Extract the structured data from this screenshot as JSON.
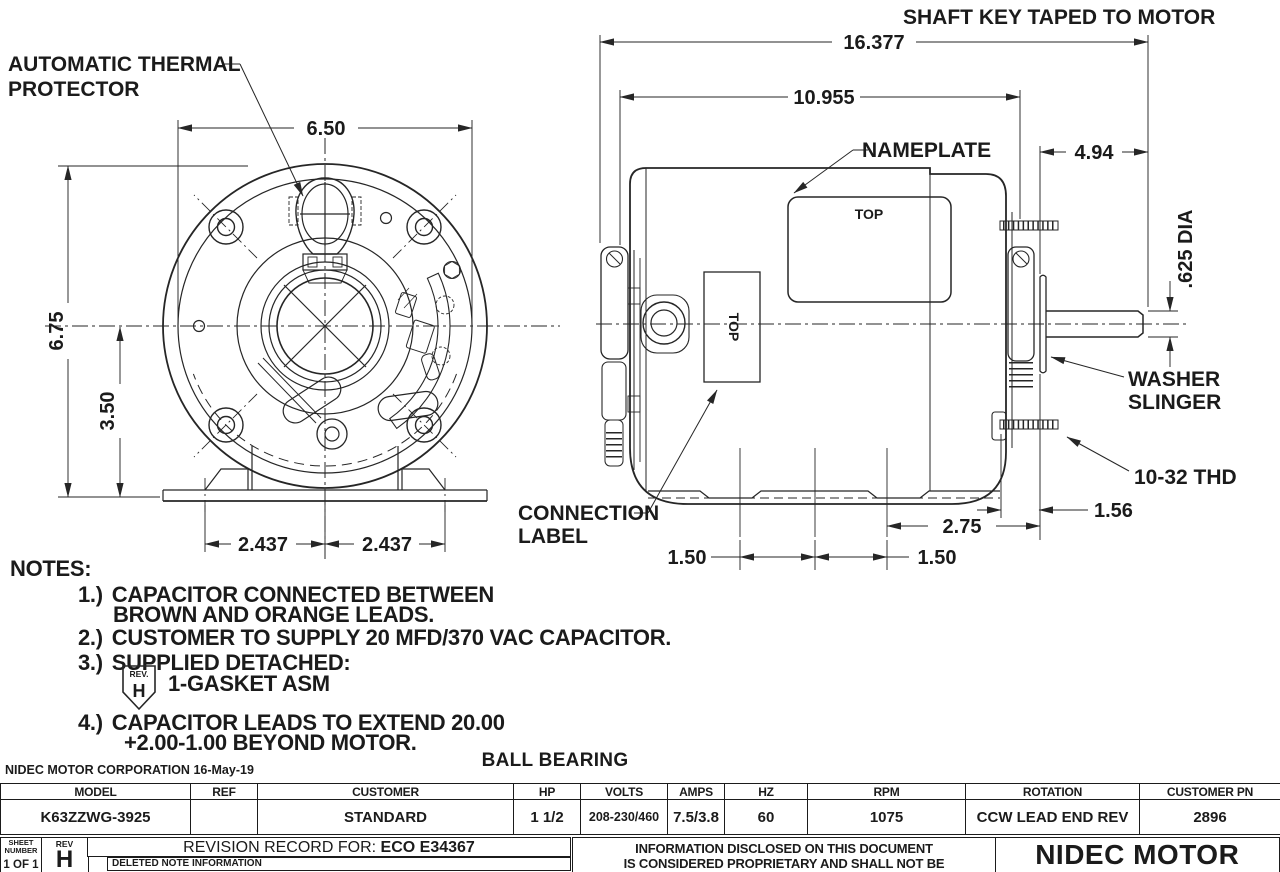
{
  "drawing": {
    "labels": {
      "thermal_line1": "AUTOMATIC THERMAL",
      "thermal_line2": "PROTECTOR",
      "shaft_key": "SHAFT KEY TAPED TO MOTOR",
      "nameplate": "NAMEPLATE",
      "nameplate_top": "TOP",
      "connection_top": "TOP",
      "washer_line1": "WASHER",
      "washer_line2": "SLINGER",
      "thread_spec": "10-32 THD",
      "connection_line1": "CONNECTION",
      "connection_line2": "LABEL"
    },
    "dims": {
      "front_width": "6.50",
      "front_height": "6.75",
      "shaft_centerline_height": "3.50",
      "foot_left": "2.437",
      "foot_right": "2.437",
      "overall_length": "16.377",
      "body_length": "10.955",
      "shaft_extension": "4.94",
      "shaft_dia": ".625 DIA",
      "stud_length": "1.56",
      "foot_to_end": "2.75",
      "bolt_spacing_a": "1.50",
      "bolt_spacing_b": "1.50"
    }
  },
  "notes": {
    "title": "NOTES:",
    "n1_num": "1.)",
    "n1_line1": "CAPACITOR CONNECTED BETWEEN",
    "n1_line2": "BROWN AND ORANGE LEADS.",
    "n2_num": "2.)",
    "n2_line1": "CUSTOMER TO SUPPLY 20 MFD/370 VAC CAPACITOR.",
    "n3_num": "3.)",
    "n3_line1": "SUPPLIED DETACHED:",
    "n3_flag_label": "REV.",
    "n3_flag_letter": "H",
    "n3_detail": "1-GASKET ASM",
    "n4_num": "4.)",
    "n4_line1": "CAPACITOR LEADS TO EXTEND 20.00",
    "n4_line2": "+2.00-1.00 BEYOND MOTOR."
  },
  "titleblock": {
    "corporation": "NIDEC MOTOR CORPORATION",
    "date": "16-May-19",
    "bearing_type": "BALL BEARING",
    "headers": [
      "MODEL",
      "REF",
      "CUSTOMER",
      "HP",
      "VOLTS",
      "AMPS",
      "HZ",
      "RPM",
      "ROTATION",
      "CUSTOMER PN"
    ],
    "values": [
      "K63ZZWG-3925",
      "",
      "STANDARD",
      "1 1/2",
      "208-230/460",
      "7.5/3.8",
      "60",
      "1075",
      "CCW LEAD END REV",
      "2896"
    ],
    "sheet_label_1": "SHEET",
    "sheet_label_2": "NUMBER",
    "sheet_value": "1 OF 1",
    "rev_label": "REV",
    "rev_value": "H",
    "revision_record": "REVISION RECORD FOR:",
    "revision_eco": "ECO E34367",
    "deleted_note": "DELETED NOTE INFORMATION",
    "proprietary_line1": "INFORMATION DISCLOSED ON THIS DOCUMENT",
    "proprietary_line2": "IS CONSIDERED PROPRIETARY AND SHALL NOT BE",
    "company": "NIDEC MOTOR"
  }
}
